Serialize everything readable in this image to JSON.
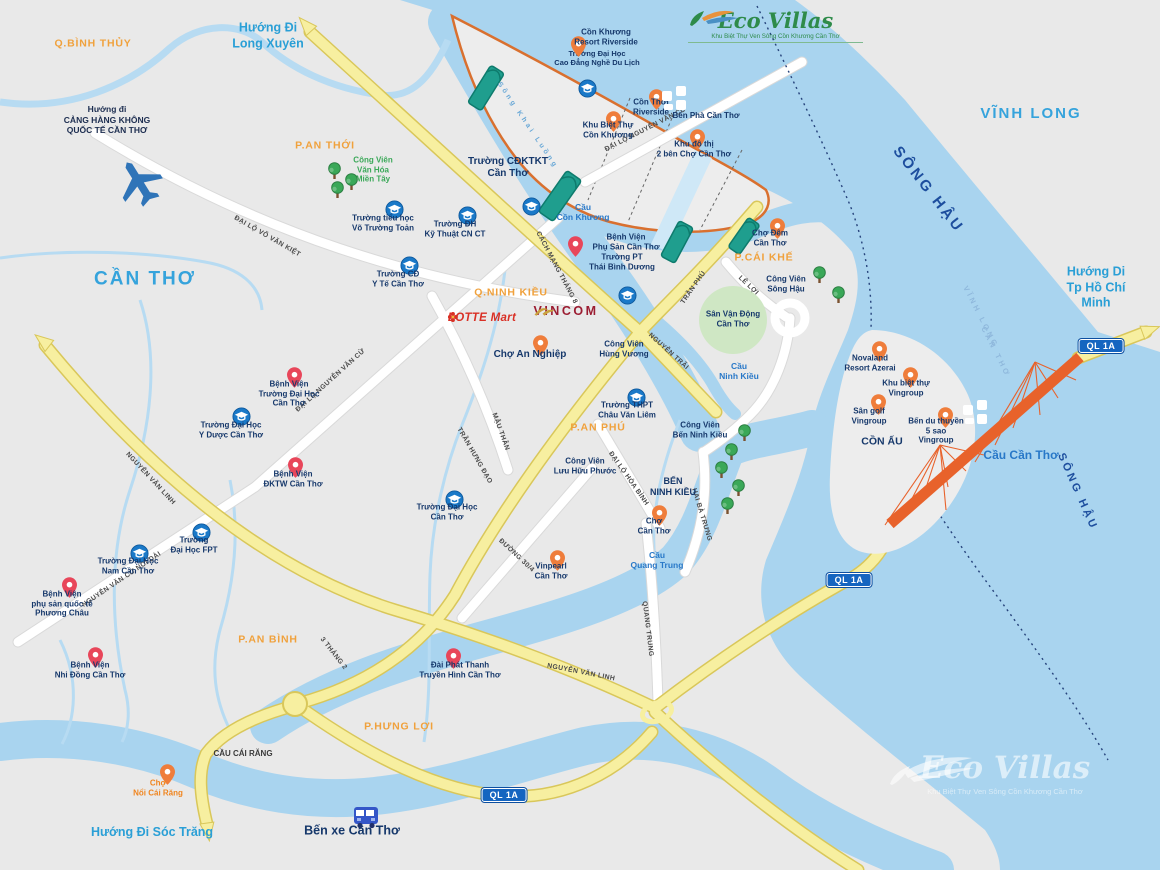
{
  "logo": {
    "name": "Eco Villas",
    "tagline": "Khu Biệt Thự Ven Sông Cồn Khương Cần Thơ"
  },
  "watermark": {
    "name": "Eco Villas",
    "tagline": "Khu Biệt Thự Ven Sông Cồn Khương Cần Thơ"
  },
  "brands": {
    "lotte": {
      "text": "LOTTE Mart",
      "x": 482,
      "y": 318,
      "color": "#d93025"
    },
    "vincom": {
      "text": "VINCOM",
      "x": 566,
      "y": 313,
      "color": "#9b1c31"
    }
  },
  "colors": {
    "water": "#a9d4ef",
    "land": "#e9e9e9",
    "road_yellow": "#f7efa0",
    "road_white": "#ffffff",
    "island_boundary": "#d9702f",
    "bridge_teal": "#1f9e8e",
    "bridge_orange": "#e8622b",
    "district_label": "#f0a13c",
    "city_label": "#35a3dc",
    "poi_label": "#16386b",
    "school_icon": "#1a79c8",
    "hospital_pin": "#e8465a",
    "place_pin": "#ef7d3b",
    "park_green": "#3aa858",
    "badge_blue": "#1565c0"
  },
  "badges": [
    {
      "id": "ql1a-east",
      "text": "QL 1A",
      "x": 1101,
      "y": 346
    },
    {
      "id": "ql1a-mid",
      "text": "QL 1A",
      "x": 849,
      "y": 580
    },
    {
      "id": "ql1a-south",
      "text": "QL 1A",
      "x": 504,
      "y": 795
    }
  ],
  "cities": [
    {
      "id": "can-tho",
      "text": "CẦN THƠ",
      "x": 145,
      "y": 280,
      "size": 19
    },
    {
      "id": "vinh-long",
      "text": "VĨNH LONG",
      "x": 1031,
      "y": 114,
      "size": 15
    }
  ],
  "districts": [
    {
      "id": "q-binh-thuy",
      "text": "Q.BÌNH THỦY",
      "x": 93,
      "y": 44
    },
    {
      "id": "p-an-thoi",
      "text": "P.AN THỚI",
      "x": 325,
      "y": 146
    },
    {
      "id": "q-ninh-kieu",
      "text": "Q.NINH KIỀU",
      "x": 511,
      "y": 293
    },
    {
      "id": "p-cai-khe",
      "text": "P.CÁI KHẾ",
      "x": 764,
      "y": 258
    },
    {
      "id": "p-an-phu",
      "text": "P.AN PHÚ",
      "x": 598,
      "y": 428
    },
    {
      "id": "p-an-binh",
      "text": "P.AN BÌNH",
      "x": 268,
      "y": 640
    },
    {
      "id": "p-hung-loi",
      "text": "P.HƯNG LỢI",
      "x": 399,
      "y": 727
    }
  ],
  "directions": [
    {
      "id": "huong-di-long-xuyen",
      "text": "Hướng Đi\nLong Xuyên",
      "x": 268,
      "y": 36
    },
    {
      "id": "huong-di-tphcm",
      "text": "Hướng Di\nTp Hồ Chí Minh",
      "x": 1096,
      "y": 288
    },
    {
      "id": "huong-di-soc-trang",
      "text": "Hướng Đi Sóc Trăng",
      "x": 152,
      "y": 833
    },
    {
      "id": "huong-di-san-bay",
      "text": "Hướng đi\nCẢNG HÀNG KHÔNG\nQUỐC TẾ CẦN THƠ",
      "x": 107,
      "y": 120,
      "size": 8.5,
      "color": "#1c2d50"
    }
  ],
  "rivers": [
    {
      "id": "song-hau-upper",
      "text": "SÔNG HẬU",
      "x": 928,
      "y": 190,
      "rot": 52,
      "size": 15
    },
    {
      "id": "song-hau-lower",
      "text": "SÔNG HẬU",
      "x": 1077,
      "y": 492,
      "rot": 66,
      "size": 11
    },
    {
      "id": "song-khai-luong",
      "text": "Sông Khai Luồng",
      "x": 527,
      "y": 126,
      "rot": 56,
      "size": 7,
      "color": "#69a8d6"
    },
    {
      "id": "boundary-vinh-long",
      "text": "VĨNH LONG",
      "x": 981,
      "y": 317,
      "rot": 63,
      "size": 7.5,
      "color": "#8fb8dc"
    },
    {
      "id": "boundary-can-tho",
      "text": "CẦN THƠ",
      "x": 996,
      "y": 352,
      "rot": 63,
      "size": 7.5,
      "color": "#8fb8dc"
    }
  ],
  "bridges": [
    {
      "id": "cau-con-khuong",
      "text": "Cầu\nCồn Khương",
      "x": 583,
      "y": 212
    },
    {
      "id": "cau-ninh-kieu",
      "text": "Cầu\nNinh Kiều",
      "x": 739,
      "y": 371
    },
    {
      "id": "cau-quang-trung",
      "text": "Cầu\nQuang Trung",
      "x": 657,
      "y": 560
    },
    {
      "id": "cau-can-tho",
      "text": "Cầu Cần Thơ",
      "x": 1021,
      "y": 455,
      "size": 12
    },
    {
      "id": "cau-cai-rang",
      "text": "CẦU CÁI RĂNG",
      "x": 243,
      "y": 754,
      "size": 8,
      "color": "#3a3a3a"
    }
  ],
  "road_labels": [
    {
      "id": "dai-lo-vo-van-kiet",
      "text": "ĐẠI LỘ VÕ VĂN KIỆT",
      "x": 267,
      "y": 237,
      "rot": 30
    },
    {
      "id": "dai-lo-nguyen-van-cu",
      "text": "ĐẠI LỘ NGUYỄN VĂN CỪ",
      "x": 331,
      "y": 381,
      "rot": -42
    },
    {
      "id": "dai-lo-nguyen-van-cu-island",
      "text": "ĐẠI LỘ NGUYỄN VĂN CỪ",
      "x": 646,
      "y": 130,
      "rot": -27
    },
    {
      "id": "nguyen-van-cu-noi-dai",
      "text": "NGUYỄN VĂN CỪ NỐI DÀI",
      "x": 122,
      "y": 580,
      "rot": -34
    },
    {
      "id": "mau-than",
      "text": "MẬU THÂN",
      "x": 500,
      "y": 432,
      "rot": 70
    },
    {
      "id": "cach-mang-thang-8",
      "text": "CÁCH MẠNG THÁNG 8",
      "x": 556,
      "y": 268,
      "rot": 62
    },
    {
      "id": "tran-phu",
      "text": "TRẦN PHÚ",
      "x": 694,
      "y": 288,
      "rot": -55
    },
    {
      "id": "nguyen-trai",
      "text": "NGUYỄN TRÃI",
      "x": 668,
      "y": 352,
      "rot": 42
    },
    {
      "id": "tran-hung-dao",
      "text": "TRẦN HƯNG ĐẠO",
      "x": 474,
      "y": 456,
      "rot": 60
    },
    {
      "id": "3-thang-2",
      "text": "3 THÁNG 2",
      "x": 333,
      "y": 654,
      "rot": 52
    },
    {
      "id": "nguyen-van-linh-west",
      "text": "NGUYỄN VĂN LINH",
      "x": 150,
      "y": 479,
      "rot": 47
    },
    {
      "id": "nguyen-van-linh-east",
      "text": "NGUYỄN VĂN LINH",
      "x": 581,
      "y": 673,
      "rot": 11
    },
    {
      "id": "duong-30-4",
      "text": "ĐƯỜNG 30/4",
      "x": 516,
      "y": 556,
      "rot": 43
    },
    {
      "id": "quang-trung",
      "text": "QUANG TRUNG",
      "x": 647,
      "y": 629,
      "rot": 83
    },
    {
      "id": "dai-lo-hoa-binh",
      "text": "ĐẠI LỘ HÒA BÌNH",
      "x": 628,
      "y": 479,
      "rot": 55
    },
    {
      "id": "hai-ba-trung",
      "text": "HAI BÀ TRƯNG",
      "x": 701,
      "y": 515,
      "rot": 73
    },
    {
      "id": "le-loi",
      "text": "LÊ LỢI",
      "x": 748,
      "y": 286,
      "rot": 43
    }
  ],
  "pois": [
    {
      "id": "truong-dh-cao-dang-nghe-du-lich",
      "type": "school",
      "x": 578,
      "y": 79,
      "label": "Trường Đại Học\nCao Đẳng Nghề Du Lịch",
      "lx": 597,
      "ly": 58,
      "lsize": 7.5
    },
    {
      "id": "con-khuong-resort-riverside",
      "type": "pin",
      "x": 571,
      "y": 36,
      "label": "Cồn Khương\nResort Riverside",
      "lx": 606,
      "ly": 37
    },
    {
      "id": "khu-biet-thu-con-khuong",
      "type": "pin",
      "x": 606,
      "y": 111,
      "label": "Khu Biệt Thự\nCồn Khương",
      "lx": 608,
      "ly": 130
    },
    {
      "id": "con-thoi-riverside",
      "type": "pin",
      "x": 649,
      "y": 89,
      "label": "Cồn Thới\nRiverside",
      "lx": 651,
      "ly": 107
    },
    {
      "id": "khu-do-thi-2-ben",
      "type": "pin",
      "x": 690,
      "y": 129,
      "label": "Khu đô thị\n2 bên Chợ Cần Thơ",
      "lx": 694,
      "ly": 149
    },
    {
      "id": "ben-pha-can-tho",
      "type": "ferry",
      "x": 662,
      "y": 86,
      "label": "Bến Phà Cần Thơ",
      "lx": 706,
      "ly": 116
    },
    {
      "id": "truong-cdktkt-can-tho",
      "type": "school",
      "x": 522,
      "y": 197,
      "label": "Trường CĐKTKT\nCần Thơ",
      "lx": 508,
      "ly": 168,
      "lsize": 10
    },
    {
      "id": "bv-phu-san-can-tho",
      "type": "hospital",
      "x": 568,
      "y": 236,
      "label": "Bệnh Viện\nPhụ Sản Cần Thơ",
      "lx": 626,
      "ly": 242
    },
    {
      "id": "truong-pt-thai-binh-duong",
      "type": "school",
      "x": 618,
      "y": 286,
      "label": "Trường PT\nThái Bình Dương",
      "lx": 622,
      "ly": 262
    },
    {
      "id": "truong-dh-ky-thuat-cn-ct",
      "type": "school",
      "x": 458,
      "y": 206,
      "label": "Trường ĐH\nKỹ Thuật CN CT",
      "lx": 455,
      "ly": 229
    },
    {
      "id": "truong-tieu-hoc-vo-truong-toan",
      "type": "school",
      "x": 385,
      "y": 200,
      "label": "Trường tiểu học\nVõ Trường Toản",
      "lx": 383,
      "ly": 223
    },
    {
      "id": "truong-cd-y-te-can-tho",
      "type": "school",
      "x": 400,
      "y": 256,
      "label": "Trường CĐ\nY Tế Cần Thơ",
      "lx": 398,
      "ly": 279
    },
    {
      "id": "cong-vien-van-hoa-mien-tay",
      "type": "tree",
      "x": 327,
      "y": 162,
      "label": "Công Viên\nVăn Hóa\nMiền Tây",
      "lx": 373,
      "ly": 170,
      "lcolor": "#3aa858"
    },
    {
      "id": "cv-mien-tay-tree-2",
      "type": "tree",
      "x": 344,
      "y": 173
    },
    {
      "id": "cv-mien-tay-tree-3",
      "type": "tree",
      "x": 330,
      "y": 181
    },
    {
      "id": "cho-dem-can-tho",
      "type": "pin",
      "x": 770,
      "y": 218,
      "label": "Chợ Đêm\nCần Thơ",
      "lx": 770,
      "ly": 238
    },
    {
      "id": "cong-vien-song-hau",
      "type": "tree",
      "x": 812,
      "y": 266,
      "label": "Công Viên\nSông Hậu",
      "lx": 786,
      "ly": 284
    },
    {
      "id": "cv-song-hau-tree-2",
      "type": "tree",
      "x": 831,
      "y": 286
    },
    {
      "id": "san-van-dong-can-tho",
      "type": "label",
      "label": "Sân Vận Động\nCần Thơ",
      "lx": 733,
      "ly": 319,
      "lsize": 8
    },
    {
      "id": "bv-truong-dai-hoc-can-tho",
      "type": "hospital",
      "x": 287,
      "y": 367,
      "label": "Bệnh Viện\nTrường Đại Học\nCần Thơ",
      "lx": 289,
      "ly": 394
    },
    {
      "id": "truong-dh-y-duoc-can-tho",
      "type": "school",
      "x": 232,
      "y": 407,
      "label": "Trường Đại Học\nY Dược Cần Thơ",
      "lx": 231,
      "ly": 430
    },
    {
      "id": "bv-dktw-can-tho",
      "type": "hospital",
      "x": 288,
      "y": 457,
      "label": "Bệnh Viện\nĐKTW Cần Thơ",
      "lx": 293,
      "ly": 479
    },
    {
      "id": "truong-dai-hoc-can-tho",
      "type": "school",
      "x": 445,
      "y": 490,
      "label": "Trường Đại Học\nCần Thơ",
      "lx": 447,
      "ly": 512
    },
    {
      "id": "truong-dai-hoc-fp",
      "type": "school",
      "x": 192,
      "y": 523,
      "label": "Trường\nĐại Học FPT",
      "lx": 194,
      "ly": 545
    },
    {
      "id": "truong-dh-nam-can-tho",
      "type": "school",
      "x": 130,
      "y": 544,
      "label": "Trường Đại Học\nNam Cần Thơ",
      "lx": 128,
      "ly": 566
    },
    {
      "id": "bv-phuong-chau",
      "type": "hospital",
      "x": 62,
      "y": 577,
      "label": "Bệnh Viện\nphụ sản quốc tế\nPhương Châu",
      "lx": 62,
      "ly": 604
    },
    {
      "id": "bv-nhi-dong-can-tho",
      "type": "hospital",
      "x": 88,
      "y": 647,
      "label": "Bệnh Viện\nNhi Đồng Cần Thơ",
      "lx": 90,
      "ly": 670
    },
    {
      "id": "cho-an-nghiep",
      "type": "pin",
      "x": 533,
      "y": 335,
      "label": "Chợ An Nghiệp",
      "lx": 530,
      "ly": 355,
      "lsize": 10
    },
    {
      "id": "cong-vien-hung-vuong",
      "type": "label",
      "label": "Công Viên\nHùng Vương",
      "lx": 624,
      "ly": 349
    },
    {
      "id": "truong-thpt-chau-van-liem",
      "type": "school",
      "x": 627,
      "y": 388,
      "label": "Trường THPT\nChâu Văn Liêm",
      "lx": 627,
      "ly": 410
    },
    {
      "id": "cong-vien-luu-huu-phuoc",
      "type": "label",
      "label": "Công Viên\nLưu Hữu Phước",
      "lx": 585,
      "ly": 466
    },
    {
      "id": "cong-vien-ben-ninh-kieu",
      "type": "label",
      "label": "Công Viên\nBến Ninh Kiều",
      "lx": 700,
      "ly": 430
    },
    {
      "id": "ben-ninh-kieu-tree-1",
      "type": "tree",
      "x": 737,
      "y": 424
    },
    {
      "id": "ben-ninh-kieu-tree-2",
      "type": "tree",
      "x": 724,
      "y": 443
    },
    {
      "id": "ben-ninh-kieu-tree-3",
      "type": "tree",
      "x": 714,
      "y": 461
    },
    {
      "id": "ben-ninh-kieu-tree-4",
      "type": "tree",
      "x": 731,
      "y": 479
    },
    {
      "id": "ben-ninh-kieu-tree-5",
      "type": "tree",
      "x": 720,
      "y": 497
    },
    {
      "id": "ben-ninh-kieu",
      "type": "label",
      "label": "BẾN\nNINH KIỀU",
      "lx": 673,
      "ly": 487,
      "lsize": 9
    },
    {
      "id": "cho-can-tho",
      "type": "pin",
      "x": 652,
      "y": 505,
      "label": "Chợ\nCần Thơ",
      "lx": 654,
      "ly": 526
    },
    {
      "id": "vinpearl-can-tho",
      "type": "pin",
      "x": 550,
      "y": 550,
      "label": "Vinpearl\nCần Thơ",
      "lx": 551,
      "ly": 571
    },
    {
      "id": "dai-phat-thanh-truyen-hinh",
      "type": "hospital",
      "x": 446,
      "y": 648,
      "label": "Đài Phát Thanh\nTruyền Hình Cần Thơ",
      "lx": 460,
      "ly": 670
    },
    {
      "id": "cho-noi-cai-rang",
      "type": "pin",
      "x": 160,
      "y": 764,
      "label": "Chợ\nNổi Cái Răng",
      "lx": 158,
      "ly": 788,
      "lcolor": "#f0851f"
    },
    {
      "id": "ben-xe-can-tho",
      "type": "bus",
      "x": 352,
      "y": 806,
      "label": "Bến xe Cần Thơ",
      "lx": 352,
      "ly": 831,
      "lsize": 12.5
    },
    {
      "id": "novaland-resort-azerai",
      "type": "pin",
      "x": 872,
      "y": 341,
      "label": "Novaland\nResort Azerai",
      "lx": 870,
      "ly": 363
    },
    {
      "id": "khu-biet-thu-vingroup",
      "type": "pin",
      "x": 903,
      "y": 367,
      "label": "Khu biệt thự\nVingroup",
      "lx": 906,
      "ly": 388
    },
    {
      "id": "san-golf-vingroup",
      "type": "pin",
      "x": 871,
      "y": 394,
      "label": "Sân golf\nVingroup",
      "lx": 869,
      "ly": 416
    },
    {
      "id": "ben-du-thuyen-vingroup",
      "type": "pin",
      "x": 938,
      "y": 407,
      "label": "Bến du thuyền\n5 sao\nVingroup",
      "lx": 936,
      "ly": 431
    },
    {
      "id": "con-au",
      "type": "label",
      "label": "CỒN ẤU",
      "lx": 882,
      "ly": 442,
      "lsize": 10.5
    },
    {
      "id": "ferry-cau-can-tho",
      "type": "ferry",
      "x": 963,
      "y": 400
    },
    {
      "id": "san-bay-plane",
      "type": "plane",
      "x": 113,
      "y": 156
    }
  ]
}
